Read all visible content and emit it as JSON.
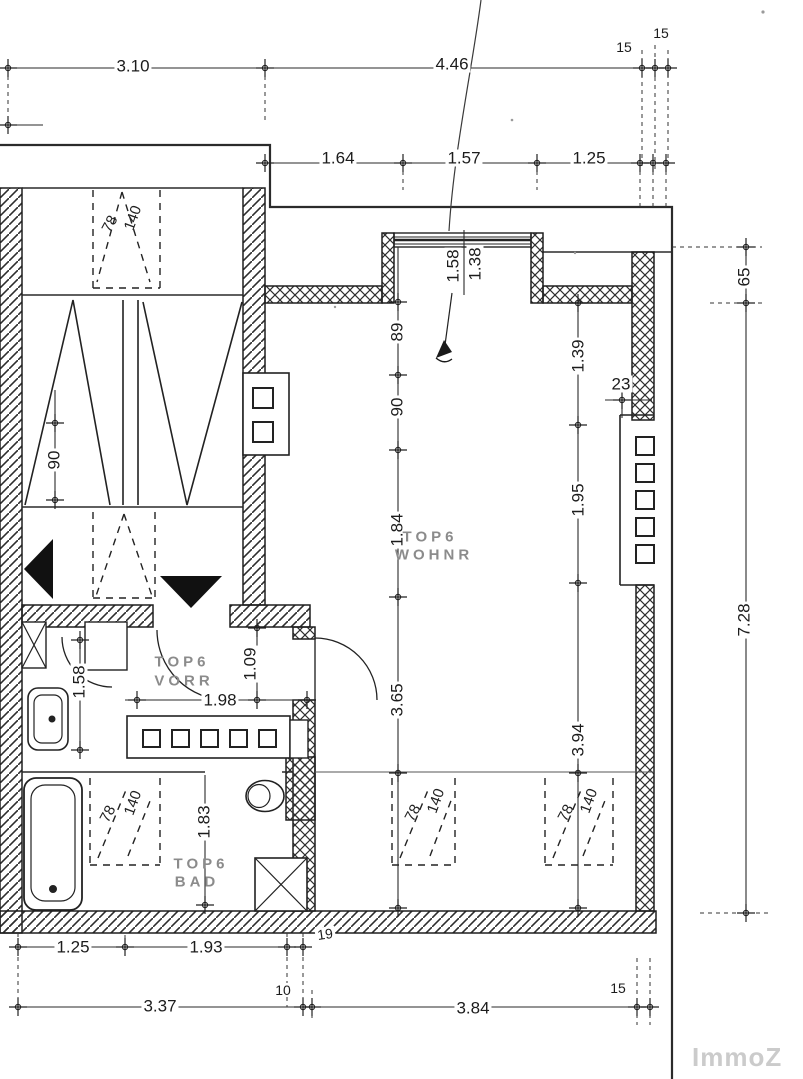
{
  "plan": {
    "rooms": {
      "wohnzimmer": {
        "l1": "TOP6",
        "l2": "WOHNR"
      },
      "vorraum": {
        "l1": "TOP6",
        "l2": "VORR"
      },
      "bad": {
        "l1": "TOP6",
        "l2": "BAD"
      }
    },
    "dimensions": {
      "t310": "3.10",
      "t446": "4.46",
      "t15a": "15",
      "t15b": "15",
      "t164": "1.64",
      "t157": "1.57",
      "t125": "1.25",
      "r65": "65",
      "r728": "7.28",
      "r23": "23",
      "r139": "1.39",
      "r195": "1.95",
      "r394": "3.94",
      "m89": "89",
      "m90": "90",
      "m184": "1.84",
      "m365": "3.65",
      "w158": "1.58",
      "w138": "1.38",
      "l90": "90",
      "v158": "1.58",
      "v109": "1.09",
      "v198": "1.98",
      "b183": "1.83",
      "f125": "1.25",
      "f193": "1.93",
      "f19": "19",
      "f337": "3.37",
      "f10": "10",
      "f384": "3.84",
      "f15": "15"
    },
    "roof_windows": [
      {
        "w": "78",
        "h": "140"
      },
      {
        "w": "78",
        "h": "140"
      },
      {
        "w": "78",
        "h": "140"
      },
      {
        "w": "78",
        "h": "140"
      }
    ],
    "watermark": "ImmoZ",
    "line_color": "#222222",
    "room_label_color": "#8b8b8b",
    "watermark_color": "#cbcbcb"
  }
}
